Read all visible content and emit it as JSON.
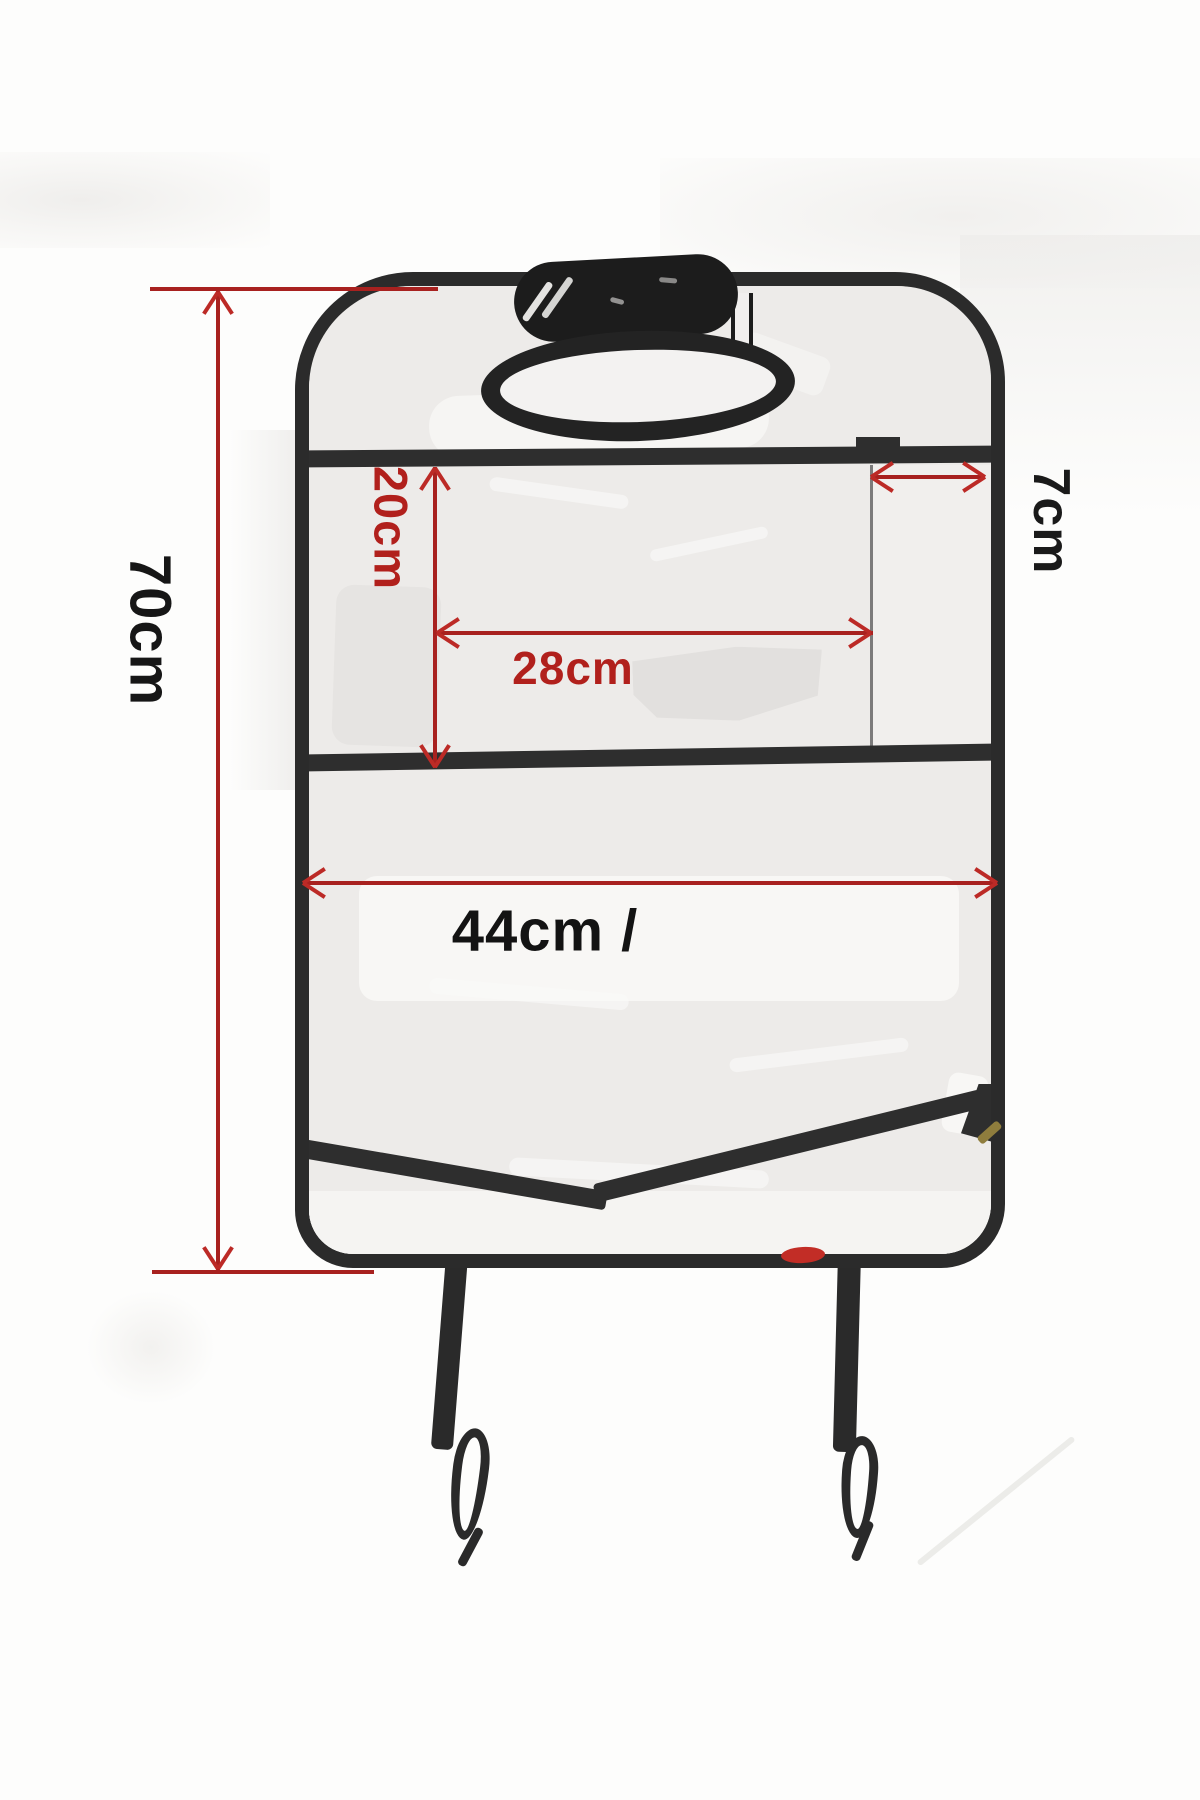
{
  "diagram": {
    "type": "product-dimension-diagram",
    "subject": "car-seat-back-protector-organizer",
    "dimensions": {
      "height": {
        "label": "70cm",
        "orientation": "vertical-left"
      },
      "top_pocket_depth": {
        "label": "20cm",
        "orientation": "vertical-inner"
      },
      "top_pocket_width": {
        "label": "28cm",
        "orientation": "horizontal-inner"
      },
      "side_pocket_width": {
        "label": "7cm",
        "orientation": "vertical-right"
      },
      "width": {
        "label": "44cm /",
        "orientation": "horizontal-inner"
      }
    },
    "colors": {
      "dimension_line": "#a8211f",
      "arrowhead": "#bc2a26",
      "red_label": "#b1201c",
      "black_label": "#161616",
      "trim": "#2b2b2b",
      "shell_fill": "#ecebe9",
      "background": "#fdfdfc",
      "red_mark": "#c22d26",
      "hook_mark": "#8f7d3d"
    }
  }
}
